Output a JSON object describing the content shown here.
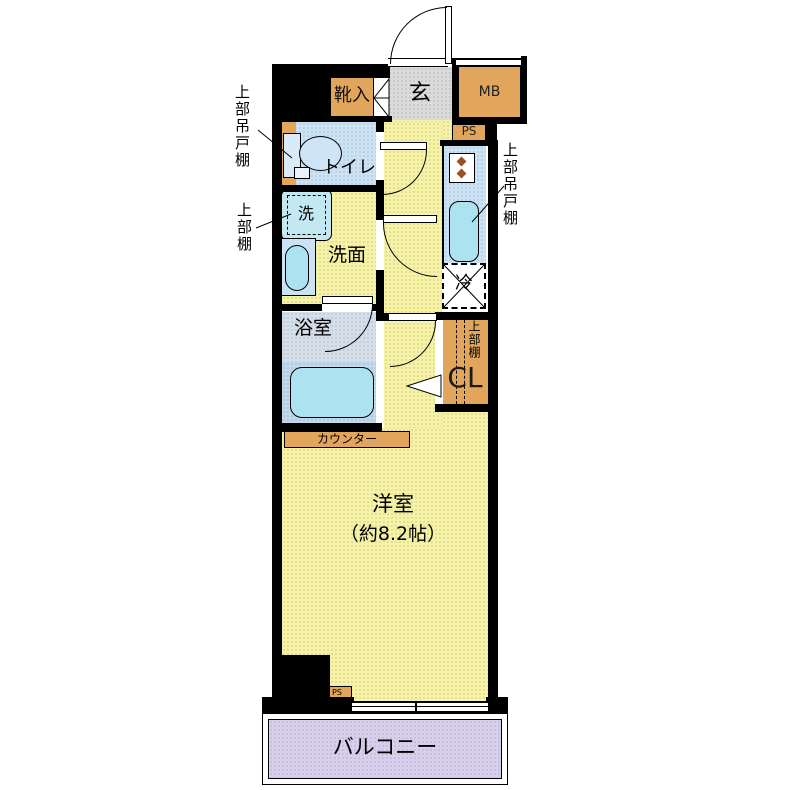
{
  "title": "floor-plan",
  "labels": {
    "entrance": "玄",
    "shoe_cabinet": "靴入",
    "meter_box": "MB",
    "pipe_shaft_upper": "PS",
    "pipe_shaft_lower": "PS",
    "toilet": "トイレ",
    "washing_machine": "洗",
    "washroom": "洗面",
    "bathroom": "浴室",
    "refrigerator": "冷",
    "closet": "CL",
    "closet_upper_shelf": "上部棚",
    "counter": "カウンター",
    "upper_cabinet_left": "上部吊戸棚",
    "upper_shelf_left": "上部棚",
    "upper_cabinet_right": "上部吊戸棚",
    "western_room": "洋室",
    "western_room_size": "（約8.2帖）",
    "balcony": "バルコニー"
  },
  "colors": {
    "wall": "#000000",
    "fixture_orange": "#E2A55C",
    "floor_yellow": "#F6F2A6",
    "entrance_gray": "#DBDBDB",
    "room_blue": "#CBE3F5",
    "water_cyan": "#ADE3F0",
    "bath_floor": "#D4DFE9",
    "bath_lower": "#C2D9ED",
    "balcony_purple": "#D8CFEC"
  }
}
